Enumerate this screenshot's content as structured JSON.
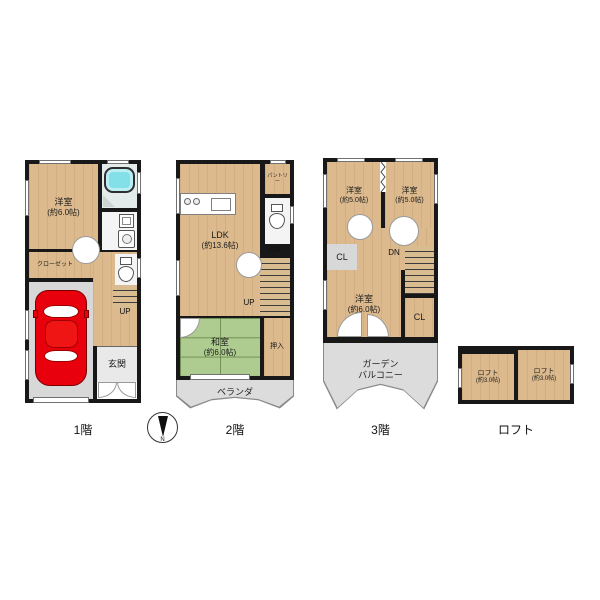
{
  "compass": {
    "n": "N"
  },
  "floor1": {
    "label": "1階",
    "bedroom": {
      "name": "洋室",
      "size": "(約6.0帖)"
    },
    "closet": {
      "name": "クローゼット"
    },
    "entrance": {
      "name": "玄関"
    },
    "stairs": {
      "up": "UP"
    }
  },
  "floor2": {
    "label": "2階",
    "ldk": {
      "name": "LDK",
      "size": "(約13.6帖)"
    },
    "pantry": {
      "name": "パントリー"
    },
    "washitsu": {
      "name": "和室",
      "size": "(約6.0帖)"
    },
    "oshiire": {
      "name": "押入"
    },
    "veranda": {
      "name": "ベランダ"
    },
    "stairs": {
      "dn": "DN",
      "up": "UP"
    }
  },
  "floor3": {
    "label": "3階",
    "bedroom_nw": {
      "name": "洋室",
      "size": "(約5.0帖)"
    },
    "bedroom_ne": {
      "name": "洋室",
      "size": "(約5.0帖)"
    },
    "bedroom_s": {
      "name": "洋室",
      "size": "(約6.0帖)"
    },
    "closet_left": {
      "name": "CL"
    },
    "closet_right": {
      "name": "CL"
    },
    "balcony": {
      "line1": "ガーデン",
      "line2": "バルコニー"
    },
    "stairs": {
      "dn": "DN"
    }
  },
  "loft": {
    "label": "ロフト",
    "room_left": {
      "name": "ロフト",
      "size": "(約3.0帖)"
    },
    "room_right": {
      "name": "ロフト",
      "size": "(約3.0帖)"
    }
  },
  "colors": {
    "wall": "#181818",
    "wood_floor": "#dcba8e",
    "tatami_green": "#aecb90",
    "balcony_gray": "#dcdcdc",
    "bathtub_cyan": "#83e0e9",
    "car_red": "#e8000d"
  }
}
